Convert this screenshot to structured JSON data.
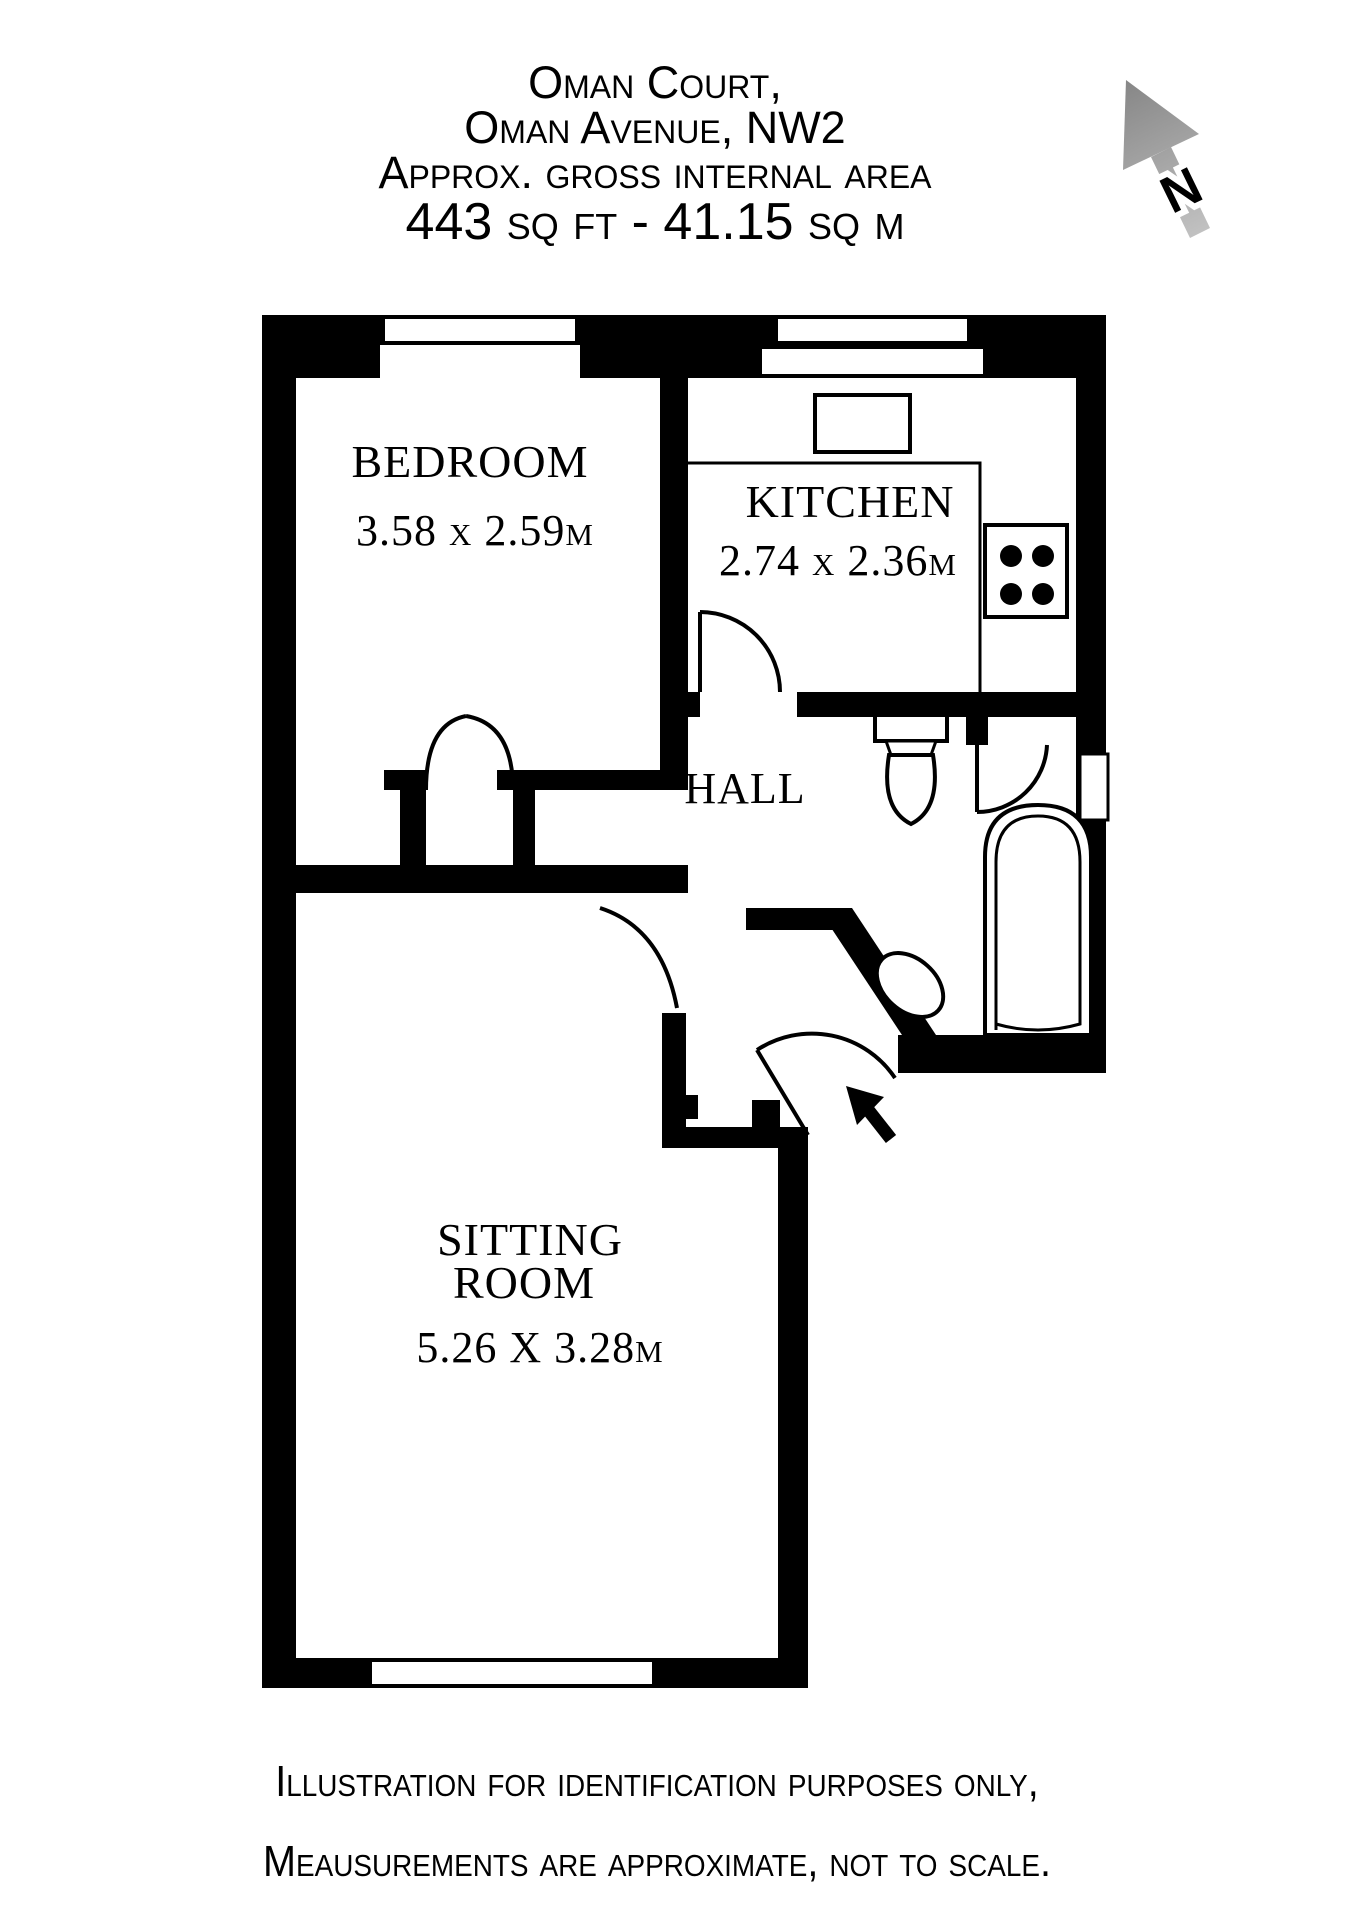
{
  "title": {
    "line1": "Oman Court,",
    "line2": "Oman Avenue, NW2",
    "line3": "Approx. gross internal area",
    "line4": "443 sq ft - 41.15 sq m"
  },
  "compass": {
    "north_label": "N"
  },
  "rooms": {
    "bedroom": {
      "name": "BEDROOM",
      "dimensions": "3.58 x 2.59m"
    },
    "kitchen": {
      "name": "KITCHEN",
      "dimensions": "2.74 x 2.36m"
    },
    "hall": {
      "name": "HALL"
    },
    "sitting_room": {
      "name_line1": "SITTING",
      "name_line2": "ROOM",
      "dimensions": "5.26 X 3.28m"
    }
  },
  "footer": {
    "line1": "Illustration for identification purposes only,",
    "line2": "Meausurements are approximate, not to scale."
  },
  "colors": {
    "walls": "#000000",
    "background": "#ffffff",
    "compass_gray_dark": "#868686",
    "compass_gray_light": "#c4c4c4"
  }
}
